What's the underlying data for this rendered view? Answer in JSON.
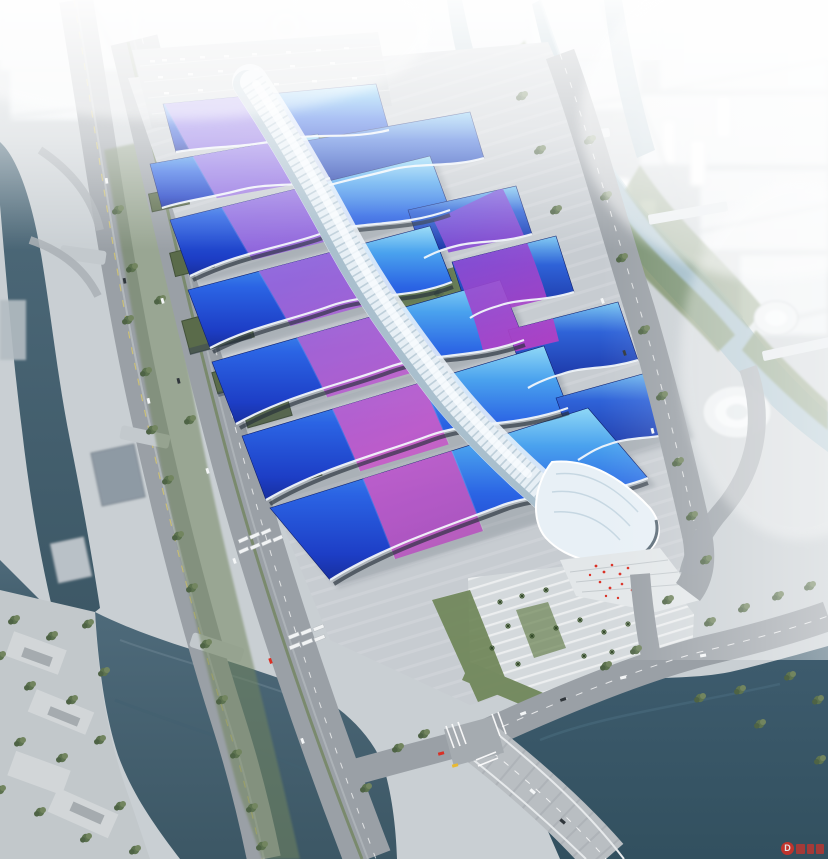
{
  "scene": {
    "kind": "aerial architectural rendering",
    "subject": "large exhibition and convention center complex with blue wave roofs, a white central concourse spine, rivers, roads and hazy city skyline"
  },
  "watermark": {
    "letter": "D"
  },
  "palette": {
    "sky_top": "#f4f8fa",
    "haze": "#ffffff",
    "land": "#c9cfd3",
    "platform": "#c7ccd1",
    "platform_light": "#d6dadd",
    "roof_cyan": "#8fd8f6",
    "roof_blue": "#2b64e4",
    "roof_deep": "#182f9e",
    "ribbon_violet": "#7f62e8",
    "ribbon_purple": "#8a4bd4",
    "ribbon_magenta": "#c13fc0",
    "spine_light": "#e7eff5",
    "spine_shade": "#a9bfcd",
    "spine_rib": "#9db4c2",
    "road": "#9aa0a6",
    "road_dark": "#878d93",
    "green_dark": "#4e6345",
    "green": "#5d7350",
    "green_light": "#72855f",
    "lawn": "#6d8455",
    "shed_green": "#5a6b4a",
    "water_west": "#4e6a7a",
    "water_dark": "#32505f",
    "canal": "#9db9c6",
    "plaza": "#d4d9dc",
    "city_block": "#eef2f4",
    "facade_dark": "#252f3a",
    "red": "#d93025"
  }
}
